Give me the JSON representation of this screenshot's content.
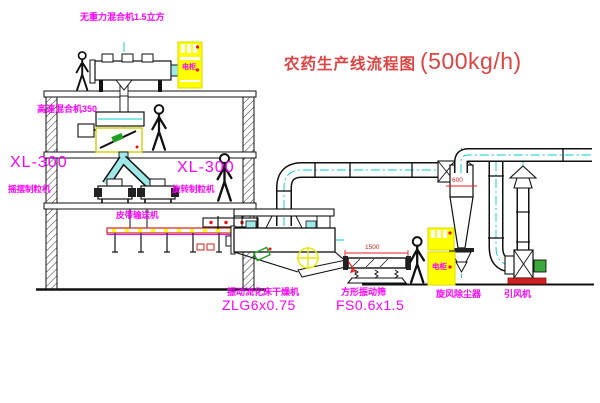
{
  "title": {
    "text": "农药生产线流程图",
    "capacity": "(500kg/h)"
  },
  "equipment": {
    "gravity_mixer": {
      "label": "无重力混合机1.5立方"
    },
    "high_speed_mixer": {
      "label": "高速混合机350"
    },
    "granulator_left": {
      "model": "XL-300",
      "name": "摇摆制粒机"
    },
    "granulator_mid": {
      "model": "XL-300",
      "name": "旋转制粒机"
    },
    "belt_conveyor": {
      "name": "皮带输送机"
    },
    "dryer": {
      "name": "振动流化床干燥机",
      "model": "ZLG6x0.75"
    },
    "sieve": {
      "name": "方形振动筛",
      "model": "FS0.6x1.5"
    },
    "cyclone": {
      "name": "旋风除尘器"
    },
    "fan": {
      "name": "引风机"
    },
    "cabinet_top": {
      "label": "电柜"
    },
    "cabinet_right": {
      "label": "电柜"
    }
  },
  "dimensions": {
    "sieve_width": "1500",
    "cyclone_diameter": "600"
  },
  "colors": {
    "label_magenta": "#ff00ff",
    "title_red": "#dd4444",
    "line_black": "#111111",
    "pipe_cyan": "#00cccc",
    "fill_cyan": "#9fe8e8",
    "cabinet_yellow": "#ffff00",
    "accent_red": "#ee1111",
    "accent_green": "#22a022",
    "center_yellow": "#e8e800"
  }
}
